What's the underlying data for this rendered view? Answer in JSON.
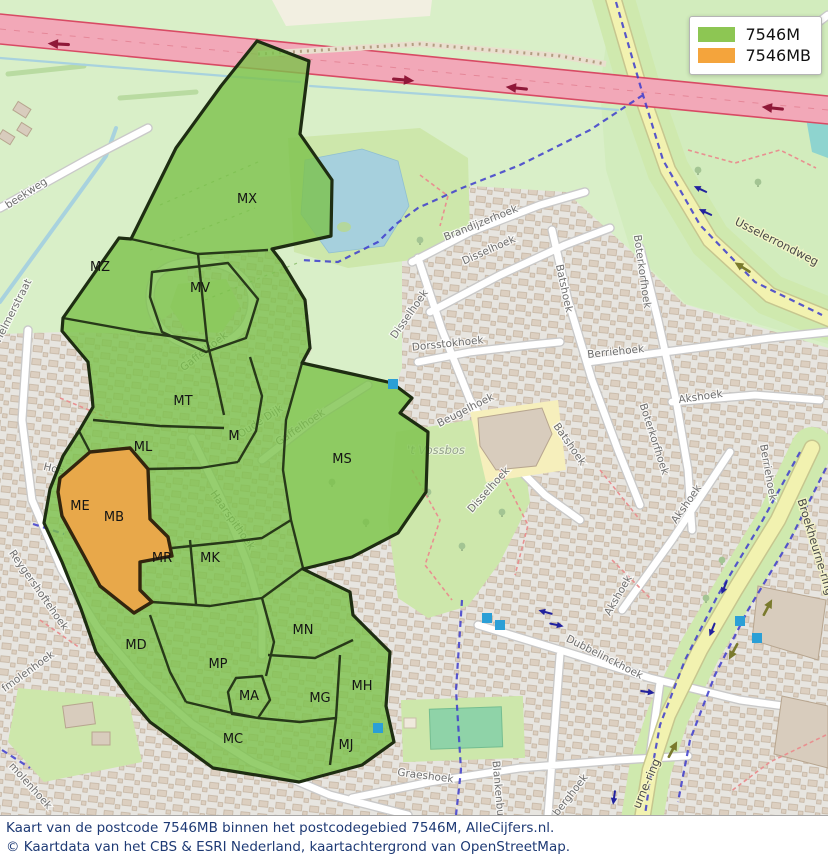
{
  "legend": {
    "items": [
      {
        "label": "7546M",
        "color": "#8dc653"
      },
      {
        "label": "7546MB",
        "color": "#f4a43c"
      }
    ]
  },
  "caption": {
    "line1": "Kaart van de postcode 7546MB binnen het postcodegebied 7546M, AlleCijfers.nl.",
    "line2": "© Kaartdata van het CBS & ESRI Nederland, kaartachtergrond van OpenStreetMap."
  },
  "regions": [
    {
      "label": "MX",
      "x": 247,
      "y": 203
    },
    {
      "label": "MZ",
      "x": 100,
      "y": 271
    },
    {
      "label": "MV",
      "x": 200,
      "y": 292
    },
    {
      "label": "MT",
      "x": 183,
      "y": 405
    },
    {
      "label": "M",
      "x": 234,
      "y": 440
    },
    {
      "label": "ML",
      "x": 143,
      "y": 451
    },
    {
      "label": "ME",
      "x": 80,
      "y": 510
    },
    {
      "label": "MB",
      "x": 114,
      "y": 521
    },
    {
      "label": "MR",
      "x": 162,
      "y": 562
    },
    {
      "label": "MK",
      "x": 210,
      "y": 562
    },
    {
      "label": "MS",
      "x": 342,
      "y": 463
    },
    {
      "label": "MN",
      "x": 303,
      "y": 634
    },
    {
      "label": "MD",
      "x": 136,
      "y": 649
    },
    {
      "label": "MP",
      "x": 218,
      "y": 668
    },
    {
      "label": "MA",
      "x": 249,
      "y": 700
    },
    {
      "label": "MG",
      "x": 320,
      "y": 702
    },
    {
      "label": "MH",
      "x": 362,
      "y": 690
    },
    {
      "label": "MC",
      "x": 233,
      "y": 743
    },
    {
      "label": "MJ",
      "x": 346,
      "y": 749
    }
  ],
  "streets": [
    {
      "text": "beekweg",
      "x": 28,
      "y": 196,
      "rot": -33
    },
    {
      "text": "Helmerstraat",
      "x": 16,
      "y": 312,
      "rot": -63
    },
    {
      "text": "Gaffelhoek",
      "x": 206,
      "y": 354,
      "rot": -38
    },
    {
      "text": "Gaffelhoek",
      "x": 302,
      "y": 430,
      "rot": -34
    },
    {
      "text": "Oude Dijk",
      "x": 262,
      "y": 424,
      "rot": -33
    },
    {
      "text": "Haarspithoek",
      "x": 230,
      "y": 522,
      "rot": 55
    },
    {
      "text": "Hoe",
      "x": 53,
      "y": 472,
      "rot": 14
    },
    {
      "text": "Reygershoftehoek",
      "x": 36,
      "y": 592,
      "rot": 55
    },
    {
      "text": "fmolenhoek",
      "x": 30,
      "y": 674,
      "rot": -36
    },
    {
      "text": "molenhoek",
      "x": 28,
      "y": 788,
      "rot": 48
    },
    {
      "text": "Brandijzerhoek",
      "x": 482,
      "y": 226,
      "rot": -22
    },
    {
      "text": "Disselhoek",
      "x": 490,
      "y": 253,
      "rot": -24
    },
    {
      "text": "Disselhoek",
      "x": 412,
      "y": 316,
      "rot": -55
    },
    {
      "text": "Dorsstokhoek",
      "x": 448,
      "y": 347,
      "rot": -6
    },
    {
      "text": "Batshoek",
      "x": 561,
      "y": 289,
      "rot": 78
    },
    {
      "text": "Batshoek",
      "x": 567,
      "y": 446,
      "rot": 55
    },
    {
      "text": "Boterkorfhoek",
      "x": 639,
      "y": 272,
      "rot": 82
    },
    {
      "text": "Boterkorfhoek",
      "x": 651,
      "y": 440,
      "rot": 72
    },
    {
      "text": "Berriehoek",
      "x": 616,
      "y": 355,
      "rot": -6
    },
    {
      "text": "Berriehoek",
      "x": 765,
      "y": 473,
      "rot": 80
    },
    {
      "text": "Akshoek",
      "x": 701,
      "y": 400,
      "rot": -8
    },
    {
      "text": "Akshoek",
      "x": 689,
      "y": 506,
      "rot": -55
    },
    {
      "text": "Akshoek",
      "x": 621,
      "y": 597,
      "rot": -60
    },
    {
      "text": "Beugelhoek",
      "x": 467,
      "y": 413,
      "rot": -27
    },
    {
      "text": "Disselhoek",
      "x": 491,
      "y": 492,
      "rot": -48
    },
    {
      "text": "Dubbelinckhoek",
      "x": 603,
      "y": 660,
      "rot": 27
    },
    {
      "text": "Graeshoek",
      "x": 425,
      "y": 779,
      "rot": 7
    },
    {
      "text": "Blankenburgerhoek",
      "x": 497,
      "y": 812,
      "rot": 85
    },
    {
      "text": "berghoek",
      "x": 573,
      "y": 797,
      "rot": -52
    },
    {
      "text": "Usselerrondweg",
      "x": 775,
      "y": 245,
      "rot": 27,
      "kind": "road"
    },
    {
      "text": "Broekheurne-ring",
      "x": 812,
      "y": 548,
      "rot": 73,
      "kind": "road"
    },
    {
      "text": "urne-ring",
      "x": 650,
      "y": 785,
      "rot": -67,
      "kind": "road"
    },
    {
      "text": "'t Vossbos",
      "x": 436,
      "y": 454,
      "rot": 0,
      "kind": "area"
    }
  ],
  "markers": {
    "bus_stop_color": "#2b9fd6",
    "points": [
      [
        393,
        384
      ],
      [
        487,
        618
      ],
      [
        500,
        625
      ],
      [
        740,
        621
      ],
      [
        757,
        638
      ],
      [
        378,
        728
      ]
    ]
  },
  "map_colors": {
    "postcode_fill": "#7cc24b",
    "postcode_mb_fill": "#efa648",
    "postcode_border": "#1e2d12",
    "motorway": "#f2a8b8",
    "yellow_road": "#f2f2b0",
    "water": "#a6d0dd",
    "grass": "#d9efc8",
    "residential": "#e7e5e0"
  }
}
